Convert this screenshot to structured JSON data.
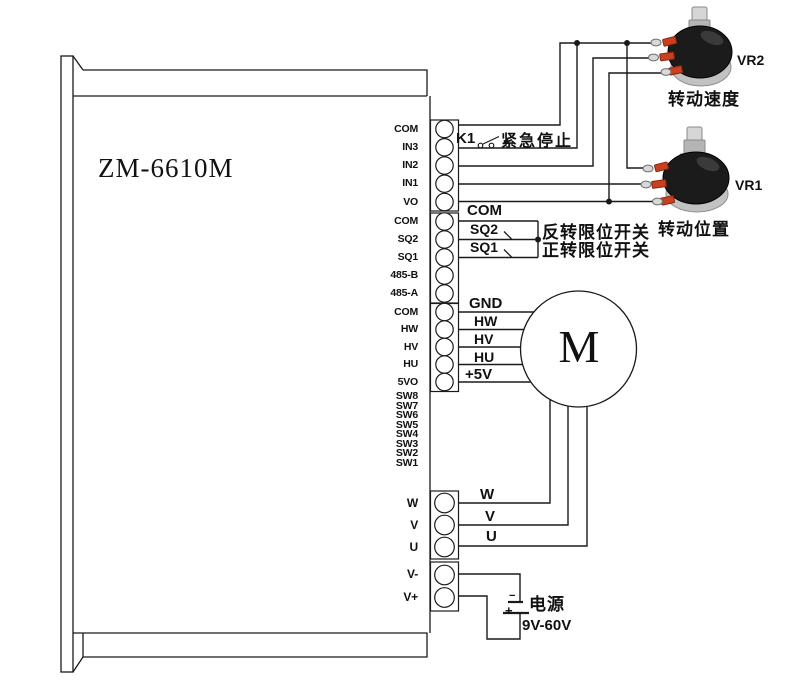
{
  "device": {
    "model": "ZM-6610M"
  },
  "terminals": {
    "group1": [
      "COM",
      "IN3",
      "IN2",
      "IN1",
      "VO"
    ],
    "group2": [
      "COM",
      "SQ2",
      "SQ1",
      "485-B",
      "485-A"
    ],
    "group3": [
      "COM",
      "HW",
      "HV",
      "HU",
      "5VO"
    ],
    "dip": [
      "SW8",
      "SW7",
      "SW6",
      "SW5",
      "SW4",
      "SW3",
      "SW2",
      "SW1"
    ],
    "group4": [
      "W",
      "V",
      "U"
    ],
    "group5": [
      "V-",
      "V+"
    ]
  },
  "wire_labels": {
    "k1": "K1",
    "estop": "紧急停止",
    "com": "COM",
    "sq2": "SQ2",
    "sq1": "SQ1",
    "gnd": "GND",
    "hw": "HW",
    "hv": "HV",
    "hu": "HU",
    "plus5v": "+5V",
    "w": "W",
    "v": "V",
    "u": "U"
  },
  "annotations": {
    "sq2_note": "反转限位开关",
    "sq1_note": "正转限位开关"
  },
  "potentiometers": {
    "vr2": {
      "label": "VR2",
      "caption": "转动速度"
    },
    "vr1": {
      "label": "VR1",
      "caption": "转动位置"
    }
  },
  "motor": {
    "letter": "M"
  },
  "power": {
    "label": "电源",
    "range": "9V-60V",
    "plus": "+",
    "minus": "−"
  },
  "colors": {
    "line": "#1a1a1a",
    "pot_body": "#1b1b1b",
    "pot_metal": "#bdbdbd",
    "pot_terminal_base": "#c8401f"
  }
}
